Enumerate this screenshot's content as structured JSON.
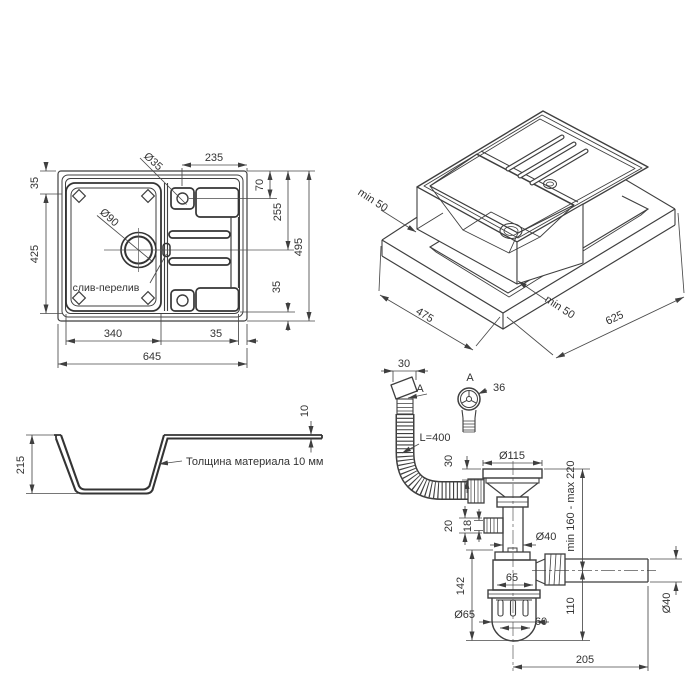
{
  "drawing": {
    "description": "Kitchen sink technical installation drawing",
    "line_color": "#3f3f3f",
    "background": "#ffffff"
  },
  "top_view": {
    "labels": {
      "drainboard_width": "235",
      "tap_hole": "Ø35",
      "margin_top": "35",
      "bowl_height": "425",
      "tap_offset": "70",
      "drain_offset": "255",
      "total_height": "495",
      "margin_bottom": "35",
      "drain_hole": "Ø90",
      "overflow": "слив-перелив",
      "bowl_width": "340",
      "gap_right": "35",
      "total_width": "645"
    }
  },
  "iso_view": {
    "labels": {
      "overhang_left": "min 50",
      "overhang_right": "min 50",
      "cutout_width": "475",
      "cutout_length": "625"
    }
  },
  "section_view": {
    "labels": {
      "depth": "215",
      "thickness": "10",
      "note": "Толщина материала 10 мм"
    }
  },
  "drain_view": {
    "labels": {
      "overflow_width": "30",
      "section_mark": "A",
      "detail_mark": "A",
      "detail_dia": "36",
      "hose_length": "L=400",
      "flange_height": "30",
      "flange_dia": "Ø115",
      "height_range": "min 160 - max 220",
      "port_outer": "20",
      "port_inner": "18",
      "pipe_dia": "Ø40",
      "body_height": "142",
      "body_width": "65",
      "cup_dia": "Ø65",
      "cup_inner": "60",
      "outlet_height": "110",
      "outlet_dia": "Ø40",
      "outlet_length": "205"
    }
  }
}
